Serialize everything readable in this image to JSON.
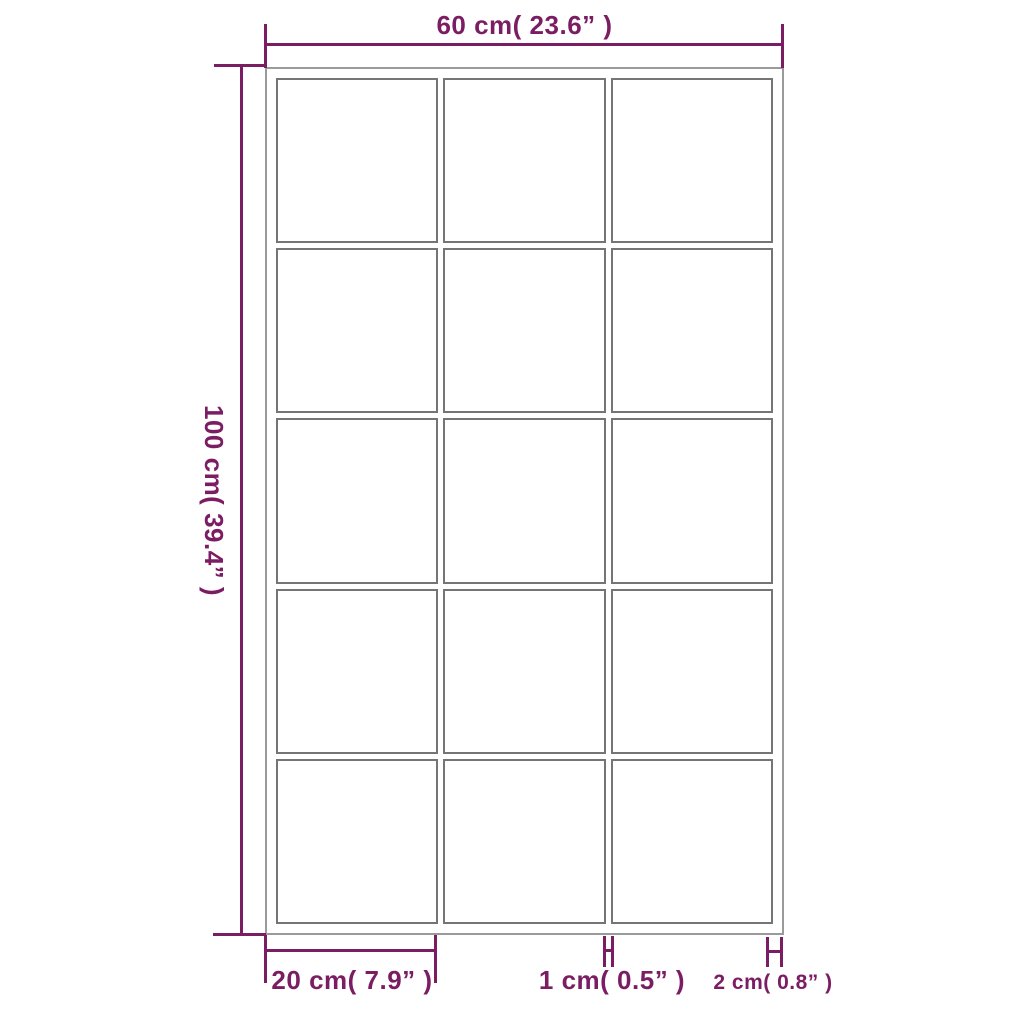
{
  "diagram": {
    "type": "product-dimension-diagram",
    "dimensions": {
      "width": {
        "label": "60 cm( 23.6”  )"
      },
      "height": {
        "label": "100 cm( 39.4”  )"
      },
      "pane_width": {
        "label": "20 cm( 7.9”  )"
      },
      "mullion_width": {
        "label": "1 cm( 0.5”  )"
      },
      "frame_thickness": {
        "label": "2 cm( 0.8”  )"
      }
    },
    "grid": {
      "rows": 5,
      "cols": 3
    },
    "colors": {
      "dimension": "#7b1d63",
      "frame_border": "#9a9a9a",
      "pane_border": "#757575",
      "background": "#ffffff"
    }
  }
}
